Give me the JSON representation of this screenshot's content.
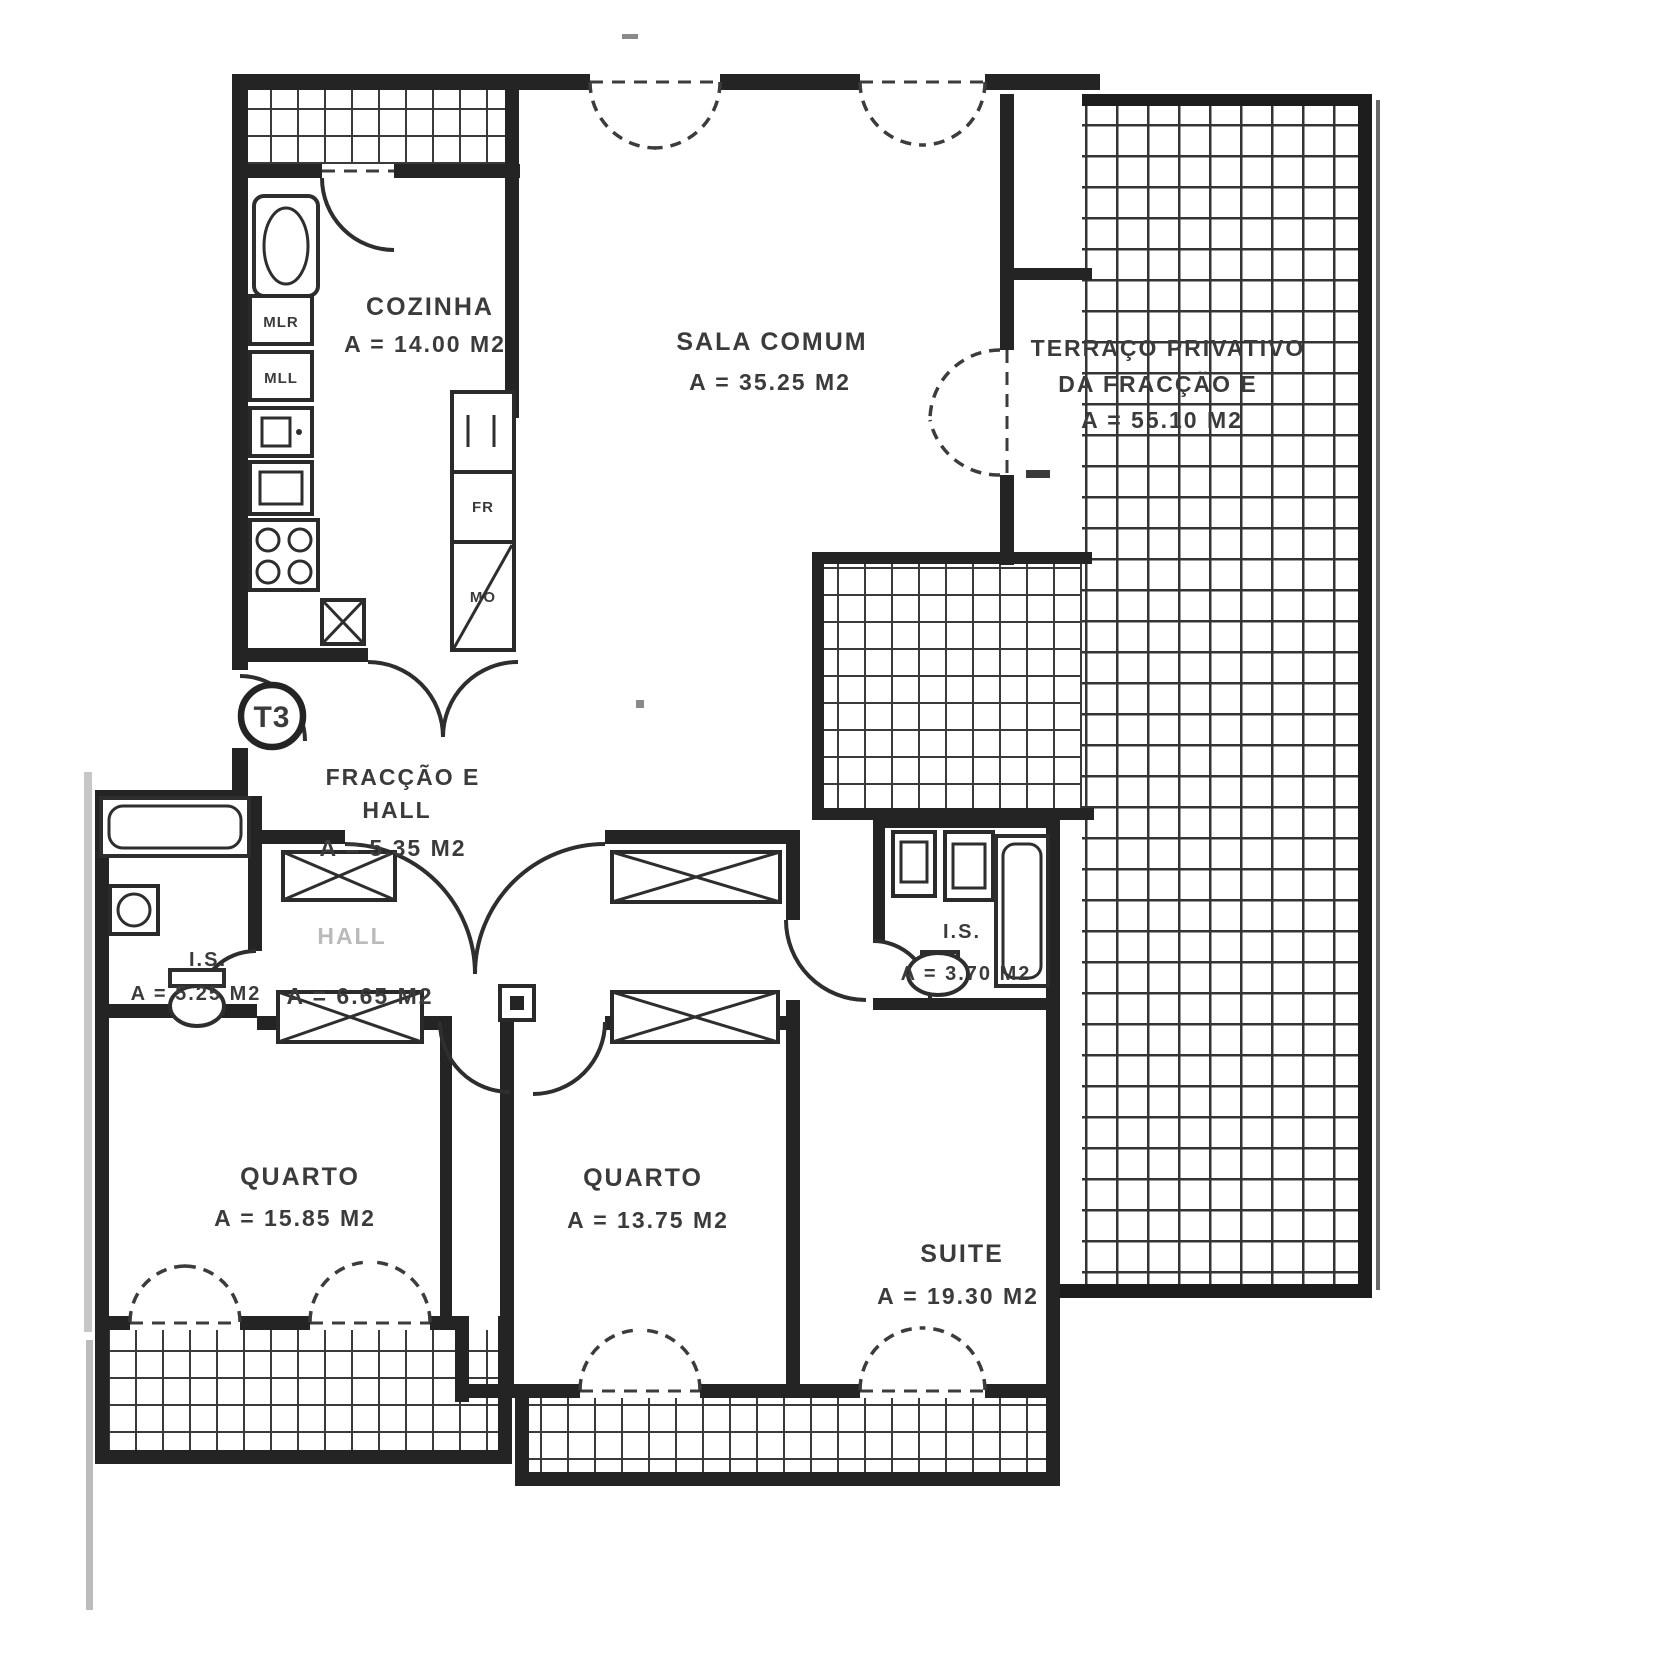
{
  "plan": {
    "badge": "T3",
    "rooms": {
      "cozinha": {
        "name": "COZINHA",
        "area": "A = 14.00 M2"
      },
      "sala_comum": {
        "name": "SALA COMUM",
        "area": "A = 35.25 M2"
      },
      "terraco": {
        "line1": "TERRAÇO PRIVATIVO",
        "line2": "DA FRACÇÃO E",
        "area": "A = 55.10 M2"
      },
      "fraccao_hall": {
        "line1": "FRACÇÃO E",
        "line2": "HALL",
        "area": "A = 5.35 M2"
      },
      "hall": {
        "name": "HALL",
        "area": "A = 6.65 M2"
      },
      "is_esq": {
        "name": "I.S.",
        "area": "A = 5.25 M2"
      },
      "is_suite": {
        "name": "I.S.",
        "area": "A = 3.70 M2"
      },
      "quarto_1": {
        "name": "QUARTO",
        "area": "A = 15.85 M2"
      },
      "quarto_2": {
        "name": "QUARTO",
        "area": "A = 13.75 M2"
      },
      "suite": {
        "name": "SUITE",
        "area": "A = 19.30 M2"
      }
    },
    "appliances": {
      "mlr": "MLR",
      "mll": "MLL",
      "fr": "FR",
      "mo": "MO"
    },
    "colors": {
      "ink": "#242424",
      "paper": "#ffffff",
      "tile_line": "#343434"
    }
  }
}
